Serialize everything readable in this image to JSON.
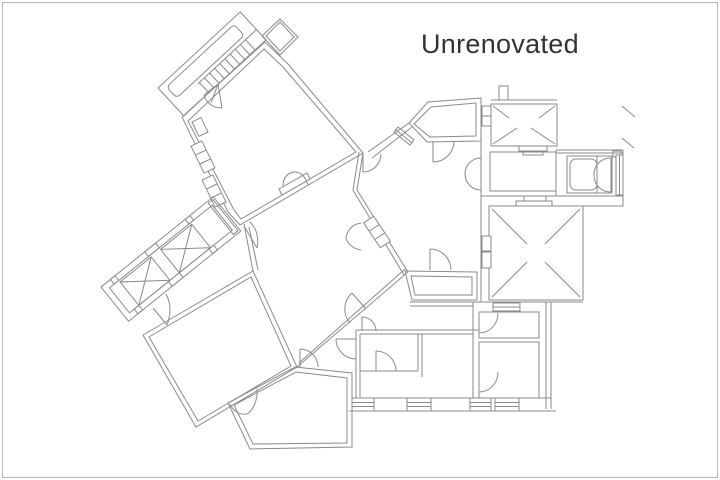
{
  "title": "Unrenovated",
  "drawing": {
    "type": "architectural-floor-plan",
    "label": "Unrenovated",
    "features": [
      "tilted-north-wing-with-balcony-and-stairs",
      "glazed-loggia-with-x-panels",
      "large-central-rooms",
      "east-wing-with-bathroom-and-skylight-court-marked-x",
      "south-rooms-with-window-wall"
    ]
  },
  "colors": {
    "background": "#ffffff",
    "frame_border": "#b9b9b9",
    "plan_line": "#8a8a8a",
    "title_text": "#333333"
  }
}
